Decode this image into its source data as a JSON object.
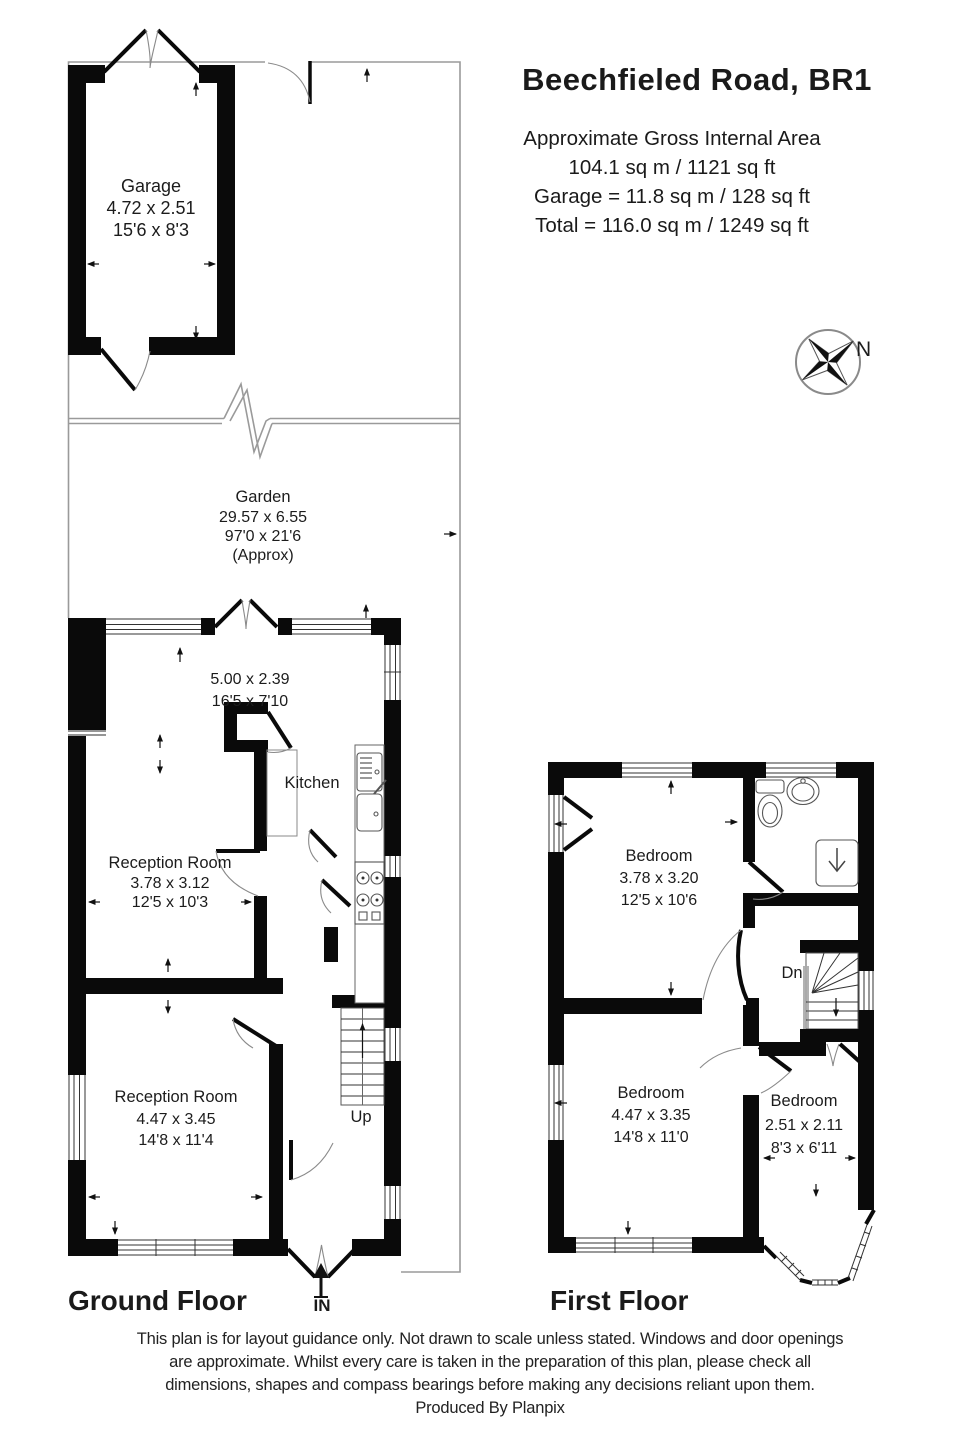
{
  "header": {
    "title": "Beechfieled Road, BR1",
    "area_lines": [
      "Approximate Gross Internal Area",
      "104.1 sq m / 1121 sq ft",
      "Garage = 11.8 sq m / 128 sq ft",
      "Total = 116.0 sq m / 1249 sq ft"
    ]
  },
  "compass": {
    "north_label": "N"
  },
  "garage": {
    "name": "Garage",
    "dim_metric": "4.72 x 2.51",
    "dim_imperial": "15'6 x 8'3"
  },
  "garden": {
    "name": "Garden",
    "dim_metric": "29.57 x 6.55",
    "dim_imperial": "97'0 x 21'6",
    "note": "(Approx)"
  },
  "ground_floor": {
    "label": "Ground Floor",
    "entrance": "IN",
    "stairs": "Up",
    "kitchen_diner": {
      "dim_metric": "5.00 x 2.39",
      "dim_imperial": "16'5 x 7'10"
    },
    "kitchen": {
      "name": "Kitchen"
    },
    "reception1": {
      "name": "Reception Room",
      "dim_metric": "3.78 x 3.12",
      "dim_imperial": "12'5 x 10'3"
    },
    "reception2": {
      "name": "Reception Room",
      "dim_metric": "4.47 x 3.45",
      "dim_imperial": "14'8 x 11'4"
    }
  },
  "first_floor": {
    "label": "First Floor",
    "stairs": "Dn",
    "bedroom1": {
      "name": "Bedroom",
      "dim_metric": "3.78 x 3.20",
      "dim_imperial": "12'5 x 10'6"
    },
    "bedroom2": {
      "name": "Bedroom",
      "dim_metric": "4.47 x 3.35",
      "dim_imperial": "14'8 x 11'0"
    },
    "bedroom3": {
      "name": "Bedroom",
      "dim_metric": "2.51 x 2.11",
      "dim_imperial": "8'3 x 6'11"
    }
  },
  "footer": {
    "disclaimer_lines": [
      "This plan is for layout guidance only. Not drawn to scale unless stated. Windows and door openings",
      "are approximate. Whilst every care is taken in the preparation of this plan, please check all",
      "dimensions, shapes and compass bearings before making any decisions reliant upon them.",
      "Produced By Planpix"
    ]
  }
}
